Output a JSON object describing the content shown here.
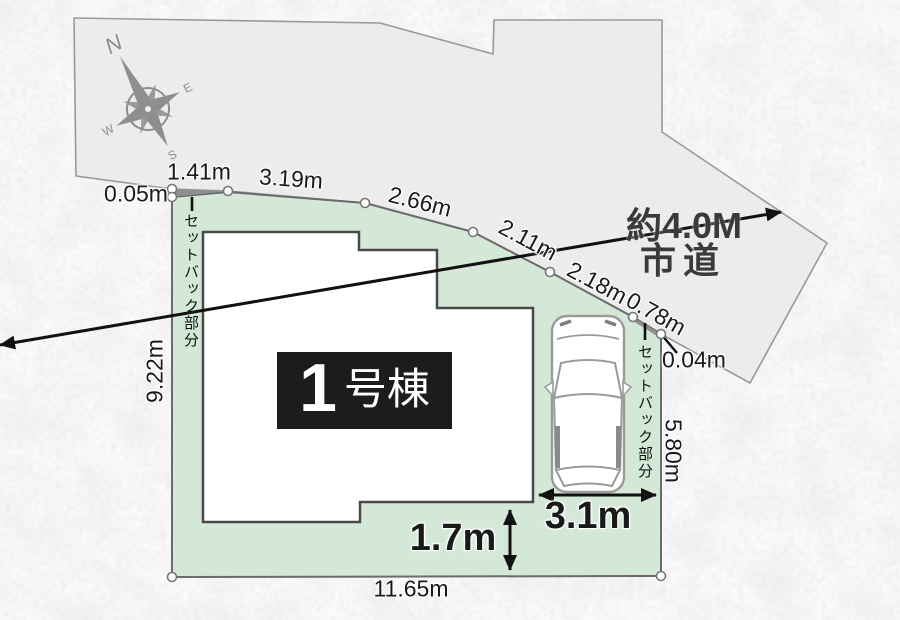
{
  "compass": {
    "n": "N",
    "e": "E",
    "s": "S",
    "w": "W"
  },
  "road": {
    "label_line1": "約4.0M",
    "label_line2": "市道"
  },
  "building": {
    "number": "1",
    "suffix": "号棟"
  },
  "measurements": {
    "gap_left": "0.05m",
    "seg_1_41": "1.41m",
    "seg_3_19": "3.19m",
    "seg_2_66": "2.66m",
    "seg_2_11": "2.11m",
    "seg_2_18": "2.18m",
    "seg_0_78": "0.78m",
    "gap_right": "0.04m",
    "west_edge": "9.22m",
    "east_edge": "5.80m",
    "south_edge": "11.65m"
  },
  "parking": {
    "width": "3.1m",
    "depth": "1.7m"
  },
  "setback": {
    "left_label": "セットバック部分",
    "right_label": "セットバック部分"
  }
}
